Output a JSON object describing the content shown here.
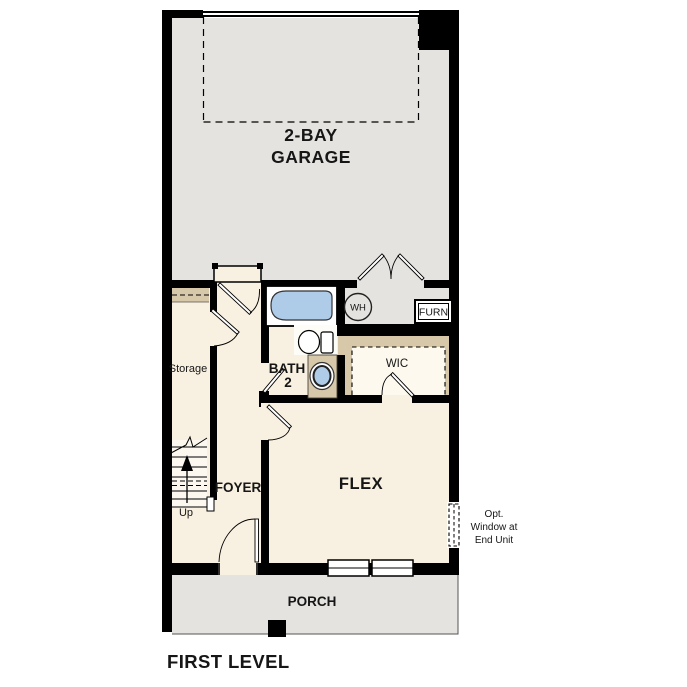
{
  "plan_title": "FIRST LEVEL",
  "garage": {
    "line1": "2-BAY",
    "line2": "GARAGE"
  },
  "storage": {
    "label": "Storage"
  },
  "bath": {
    "line1": "BATH",
    "line2": "2"
  },
  "water_heater": {
    "label": "WH"
  },
  "furnace": {
    "label": "FURN"
  },
  "wic": {
    "label": "WIC"
  },
  "foyer": {
    "label": "FOYER"
  },
  "flex": {
    "label": "FLEX"
  },
  "stairs": {
    "label": "Up"
  },
  "porch": {
    "label": "PORCH"
  },
  "opt_window_note": {
    "line1": "Opt.",
    "line2": "Window at",
    "line3": "End Unit"
  },
  "colors": {
    "wall": "#000000",
    "garage_floor": "#e4e3e0",
    "interior_floor": "#f8f0e1",
    "shelf_tan": "#d7c8aa",
    "fixture_blue": "#aecbe8",
    "porch_floor": "#e4e3e0",
    "text": "#161616"
  }
}
